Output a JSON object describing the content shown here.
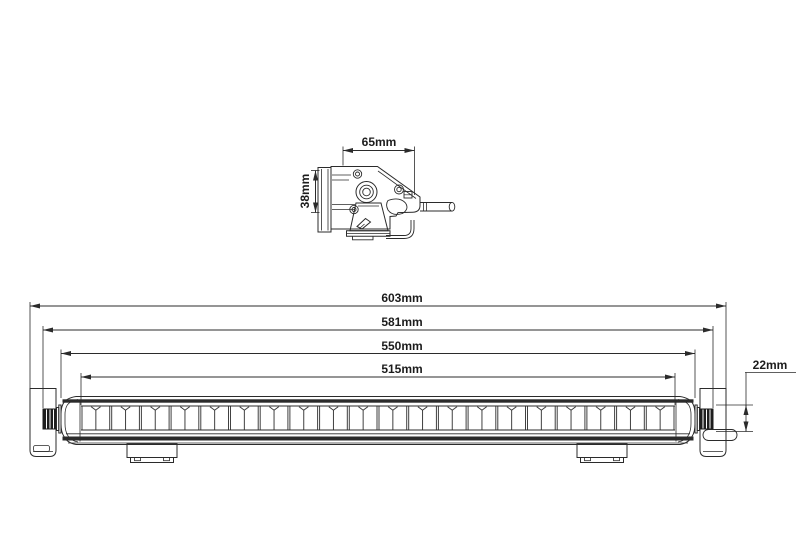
{
  "page": {
    "background": "#ffffff",
    "line_color": "#2b2b2b",
    "description": "Technical dimension drawing of an LED light bar: side profile view (top) and front elevation view (bottom)"
  },
  "side_view": {
    "width_dimension": "65mm",
    "height_dimension": "38mm"
  },
  "front_view": {
    "length_dimensions": [
      "603mm",
      "581mm",
      "550mm",
      "515mm"
    ],
    "end_fixing_height_dimension": "22mm",
    "led_segment_count": 20,
    "mounting_feet_count": 2
  }
}
